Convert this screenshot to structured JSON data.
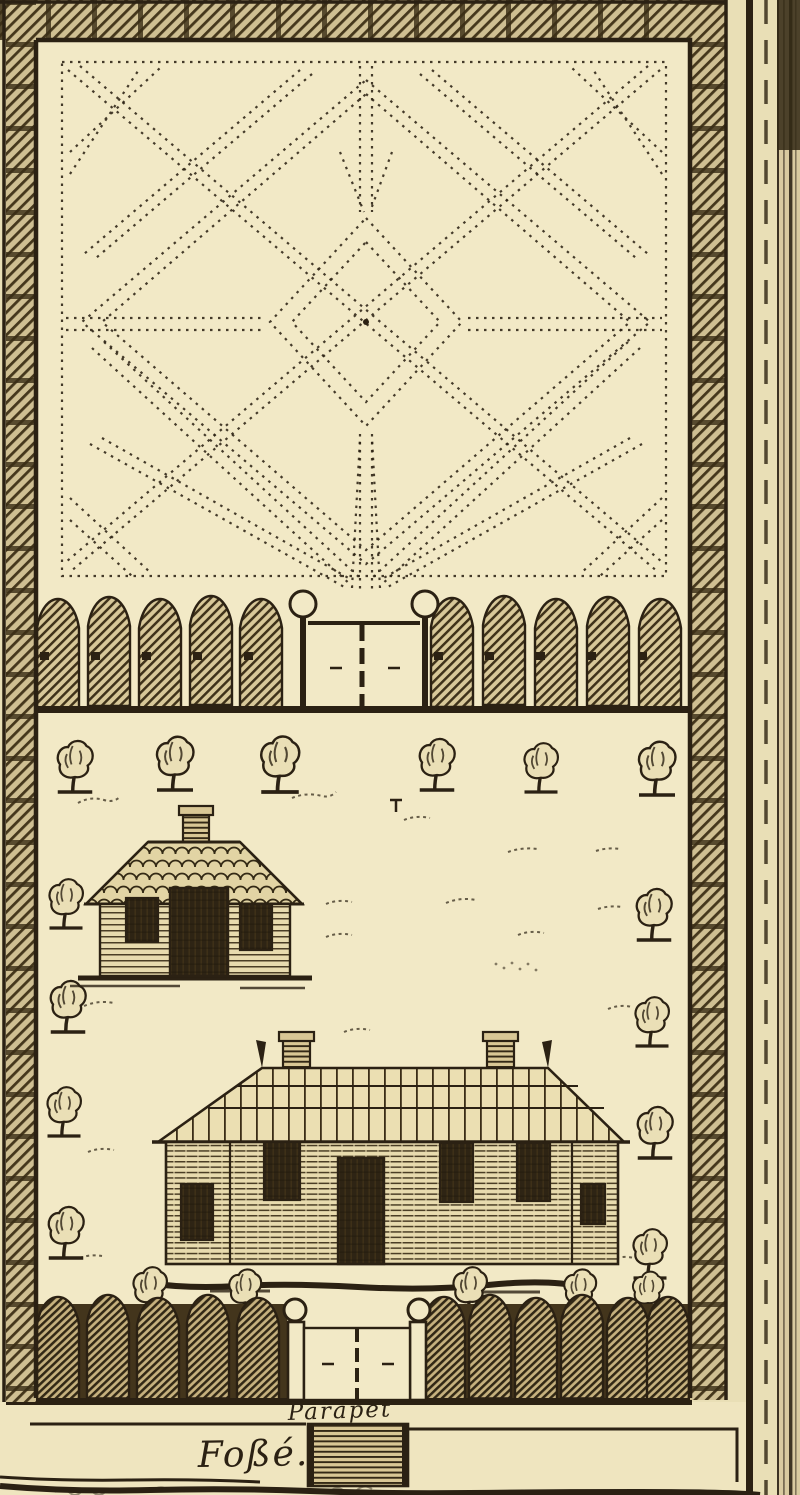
{
  "figure": {
    "labels": {
      "parapet": "Parapet",
      "fosse": "Foßé."
    },
    "palette": {
      "paper": "#e9dfb6",
      "paper_light": "#f2e9c6",
      "ink": "#2b2113",
      "wall_fill": "#cfbf92",
      "hatch_line": "#45371c",
      "picket_fill": "#d8c899",
      "picket_line": "#3f321a",
      "picket_low_fill": "#c6b17e",
      "picket_low_line": "#322815",
      "house_fill": "#e8dbae",
      "dark_fill": "#2e2414"
    }
  }
}
